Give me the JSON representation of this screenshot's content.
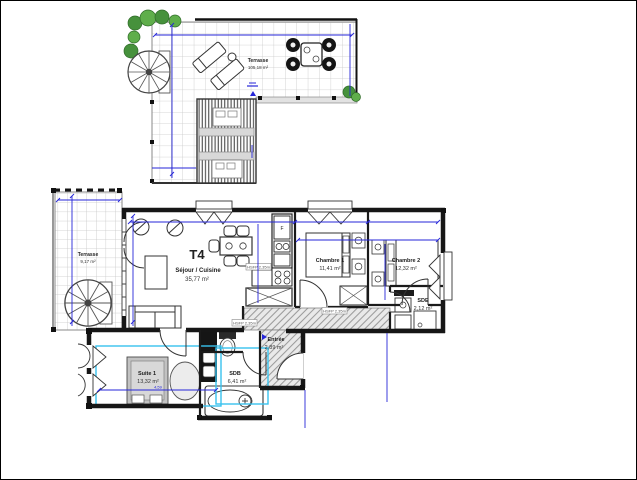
{
  "plan": {
    "apartment_type": "T4",
    "rooms": [
      {
        "name": "Séjour / Cuisine",
        "area": "35,77 m²"
      },
      {
        "name": "Chambre 1",
        "area": "11,41 m²"
      },
      {
        "name": "Chambre 2",
        "area": "12,32 m²"
      },
      {
        "name": "SDE",
        "area": "2,12 m²"
      },
      {
        "name": "Entrée",
        "area": "2,89 m²"
      },
      {
        "name": "Suite 1",
        "area": "13,32 m²"
      },
      {
        "name": "SDB",
        "area": "6,41 m²"
      },
      {
        "name": "Terrasse",
        "area": "9,17 m²"
      },
      {
        "name": "Terrasse",
        "area": "105,18 m²"
      }
    ],
    "annotations": {
      "ceiling_height": "HSFP 2,35m",
      "fridge": "F",
      "suite_width_dim": "4,59"
    },
    "colors": {
      "wall": "#161616",
      "dimension_blue": "#2626d8",
      "highlight_cyan": "#38c2ee",
      "plant_green": "#3d8c38",
      "hatch_gray": "#9b9b9b"
    }
  }
}
